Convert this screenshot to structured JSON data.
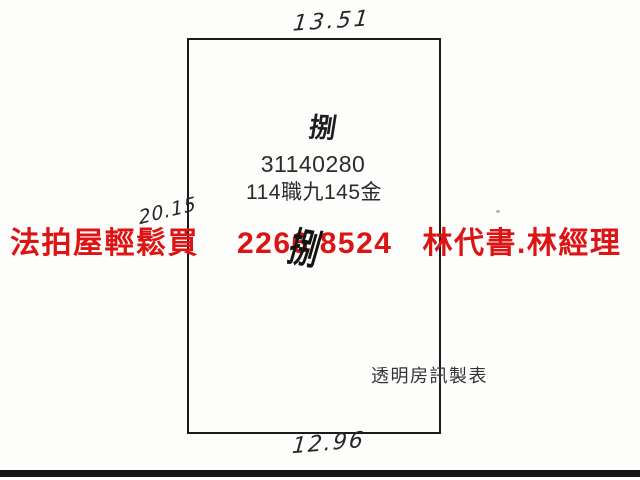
{
  "parcel": {
    "top_dimension": "13.51",
    "left_dimension": "20.15",
    "bottom_dimension": "12.96",
    "lot_label": "捌",
    "lot_number": "31140280",
    "lot_reference": "114職九145金",
    "credit": "透明房訊製表",
    "overlap_glyph": "捌"
  },
  "watermark": {
    "agency": "法拍屋輕鬆買",
    "phone_first": "2266",
    "phone_second": "8524",
    "contacts": "林代書.林經理",
    "color": "#dd1414"
  },
  "colors": {
    "background": "#fdfdfc",
    "border_ink": "#1b1b1b",
    "text_ink": "#2b2b2b",
    "watermark_red": "#dd1414",
    "bottom_bar": "#151515"
  }
}
